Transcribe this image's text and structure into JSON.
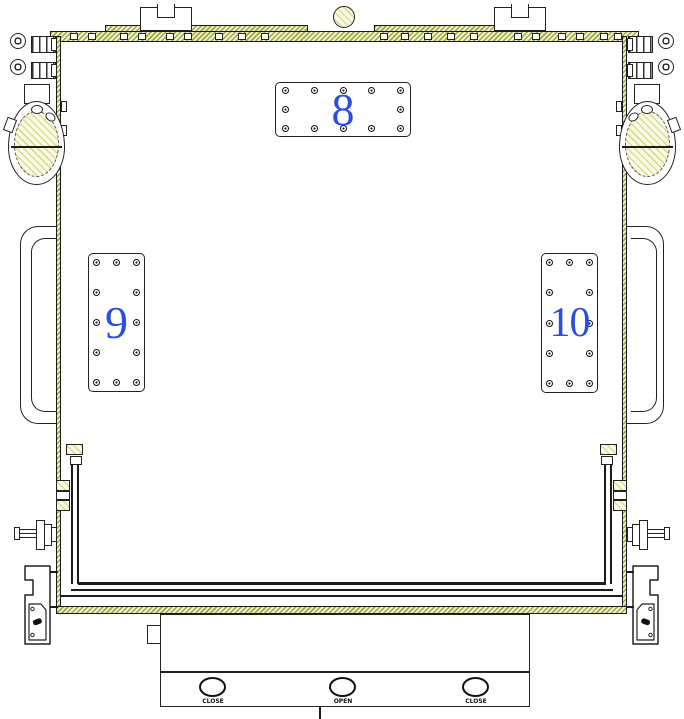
{
  "drawing": {
    "type": "mechanical engineering side-view drawing of equipment chamber",
    "panels": {
      "top": "8",
      "left": "9",
      "right": "10"
    },
    "valve_buttons": [
      "CLOSE",
      "OPEN",
      "CLOSE"
    ],
    "colors": {
      "panel_number_blue": "#2a4fe0",
      "outline": "#1c1c1c",
      "wall_hatch_olive": "#a3a638",
      "component_hatch_yellow": "#dadd8e"
    }
  }
}
